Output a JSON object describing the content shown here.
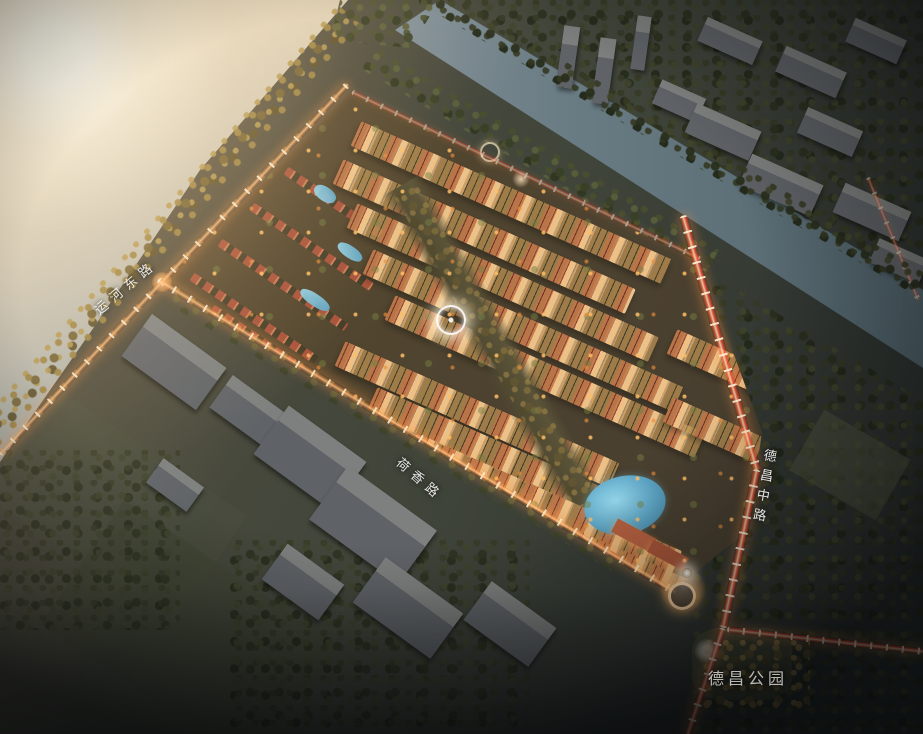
{
  "labels": {
    "road_canal_east": "运河东路",
    "road_hexiang": "荷香路",
    "road_dechang_middle": "德昌中路",
    "park_dechang": "德昌公园"
  },
  "colors": {
    "sun_glare": "#f2d8b4",
    "river_water": "#8e979b",
    "canal_water": "#5d7078",
    "lake_blue": "#6fb9d8",
    "tower_roof_red": "#7a3a30",
    "villa_roof": "#b05a40",
    "facade_warm": "#d8c49c",
    "road_glow": "#ffb668",
    "tail_light_red": "#ff5a3c",
    "trees_dark": "#3a412c",
    "grey_building": "#6e7270"
  }
}
